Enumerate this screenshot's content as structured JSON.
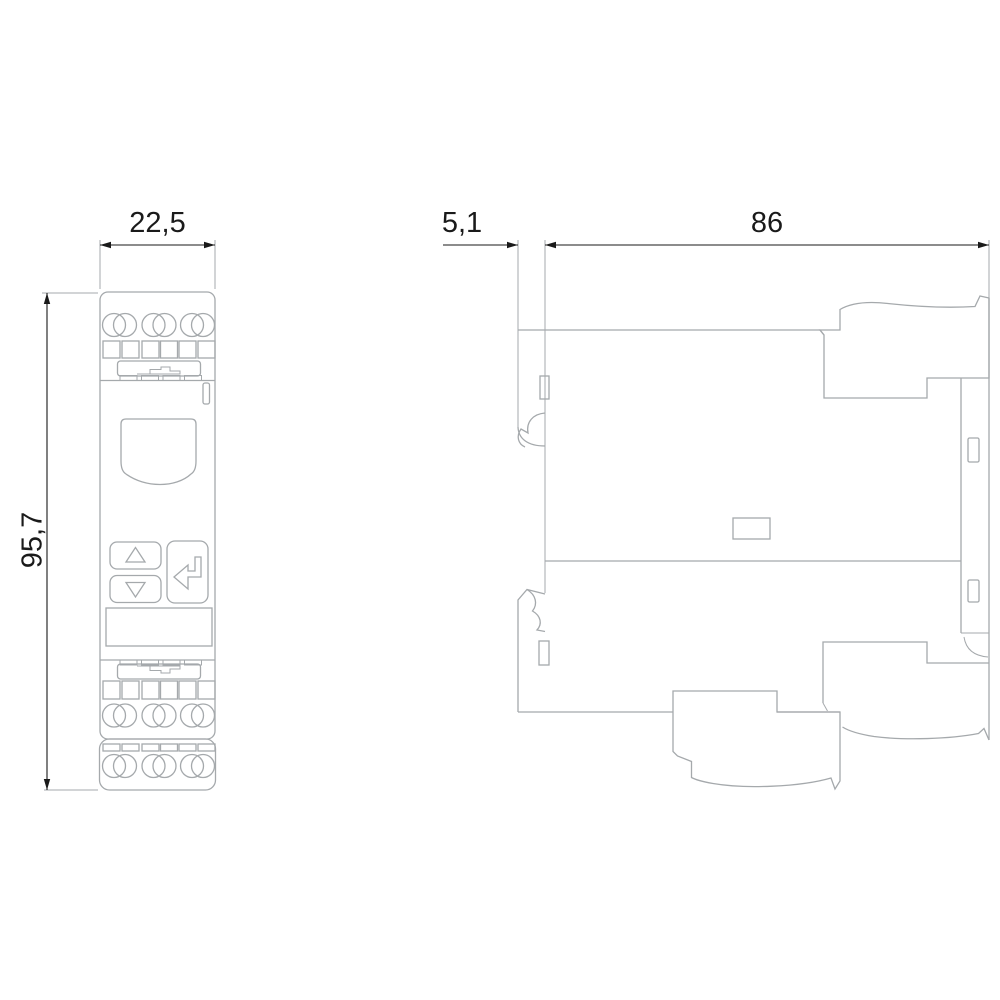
{
  "drawing": {
    "colors": {
      "outline": "#a5a9ac",
      "dimension": "#1a1a1a",
      "background": "#ffffff"
    },
    "dimensions": {
      "width": {
        "label": "22,5"
      },
      "height": {
        "label": "95,7"
      },
      "clip_depth": {
        "label": "5,1"
      },
      "depth": {
        "label": "86"
      }
    }
  }
}
